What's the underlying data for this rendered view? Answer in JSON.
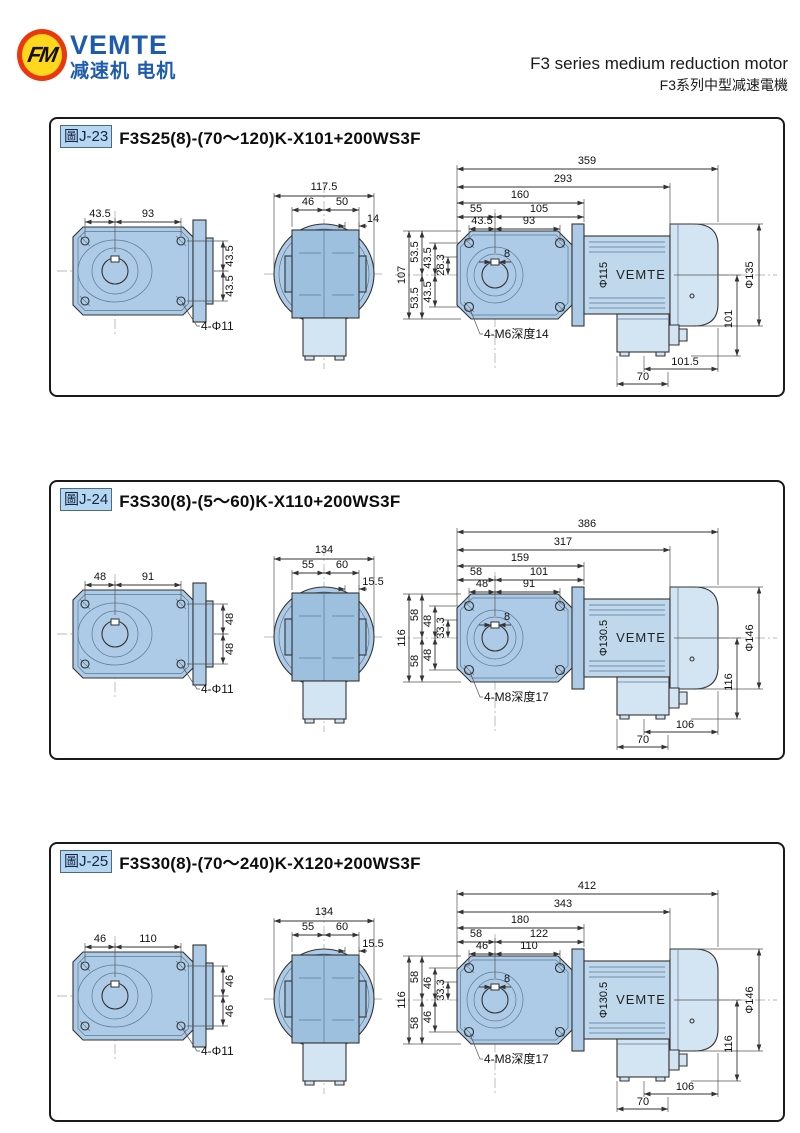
{
  "header": {
    "logo_monogram": "FM",
    "brand": "VEMTE",
    "brand_sub": "减速机 电机",
    "title_en": "F3 series medium reduction motor",
    "title_zh": "F3系列中型减速電機"
  },
  "colors": {
    "body_blue": "#adcbe6",
    "square_blue": "#9cc0de",
    "light_blue": "#d3e4f2",
    "motor_blue": "#bfd8ec",
    "brand_blue": "#1d5bad",
    "logo_red": "#e8380d",
    "logo_yellow": "#ffd71c",
    "tag_bg": "#b5d8f0",
    "line": "#333333"
  },
  "panels": [
    {
      "tag": "圖J-23",
      "title": "F3S25(8)-(70～120)K-X101+200WS3F",
      "front": {
        "top1": "43.5",
        "top2": "93",
        "right1": "43.5",
        "right2": "43.5",
        "note": "4-Φ11"
      },
      "side": {
        "width": "117.5",
        "sub1": "46",
        "sub2": "50",
        "offset": "14"
      },
      "main": {
        "total": "359",
        "body": "293",
        "gear": "160",
        "c1": "55",
        "c2": "105",
        "c3": "43.5",
        "c4": "93",
        "shaft": "8",
        "h_total": "107",
        "h_half1": "53.5",
        "h_half2": "53.5",
        "h_hole1": "43.5",
        "h_hole2": "43.5",
        "h_off": "28.3",
        "motor_dia": "Φ115",
        "brand": "VEMTE",
        "fan_dia": "Φ135",
        "side_h": "101",
        "box_w": "101.5",
        "box_b": "70",
        "tap": "4-M6深度14"
      }
    },
    {
      "tag": "圖J-24",
      "title": "F3S30(8)-(5～60)K-X110+200WS3F",
      "front": {
        "top1": "48",
        "top2": "91",
        "right1": "48",
        "right2": "48",
        "note": "4-Φ11"
      },
      "side": {
        "width": "134",
        "sub1": "55",
        "sub2": "60",
        "offset": "15.5"
      },
      "main": {
        "total": "386",
        "body": "317",
        "gear": "159",
        "c1": "58",
        "c2": "101",
        "c3": "48",
        "c4": "91",
        "shaft": "8",
        "h_total": "116",
        "h_half1": "58",
        "h_half2": "58",
        "h_hole1": "48",
        "h_hole2": "48",
        "h_off": "33.3",
        "motor_dia": "Φ130.5",
        "brand": "VEMTE",
        "fan_dia": "Φ146",
        "side_h": "116",
        "box_w": "106",
        "box_b": "70",
        "tap": "4-M8深度17"
      }
    },
    {
      "tag": "圖J-25",
      "title": "F3S30(8)-(70～240)K-X120+200WS3F",
      "front": {
        "top1": "46",
        "top2": "110",
        "right1": "46",
        "right2": "46",
        "note": "4-Φ11"
      },
      "side": {
        "width": "134",
        "sub1": "55",
        "sub2": "60",
        "offset": "15.5"
      },
      "main": {
        "total": "412",
        "body": "343",
        "gear": "180",
        "c1": "58",
        "c2": "122",
        "c3": "46",
        "c4": "110",
        "shaft": "8",
        "h_total": "116",
        "h_half1": "58",
        "h_half2": "58",
        "h_hole1": "46",
        "h_hole2": "46",
        "h_off": "33.3",
        "motor_dia": "Φ130.5",
        "brand": "VEMTE",
        "fan_dia": "Φ146",
        "side_h": "116",
        "box_w": "106",
        "box_b": "70",
        "tap": "4-M8深度17"
      }
    }
  ]
}
